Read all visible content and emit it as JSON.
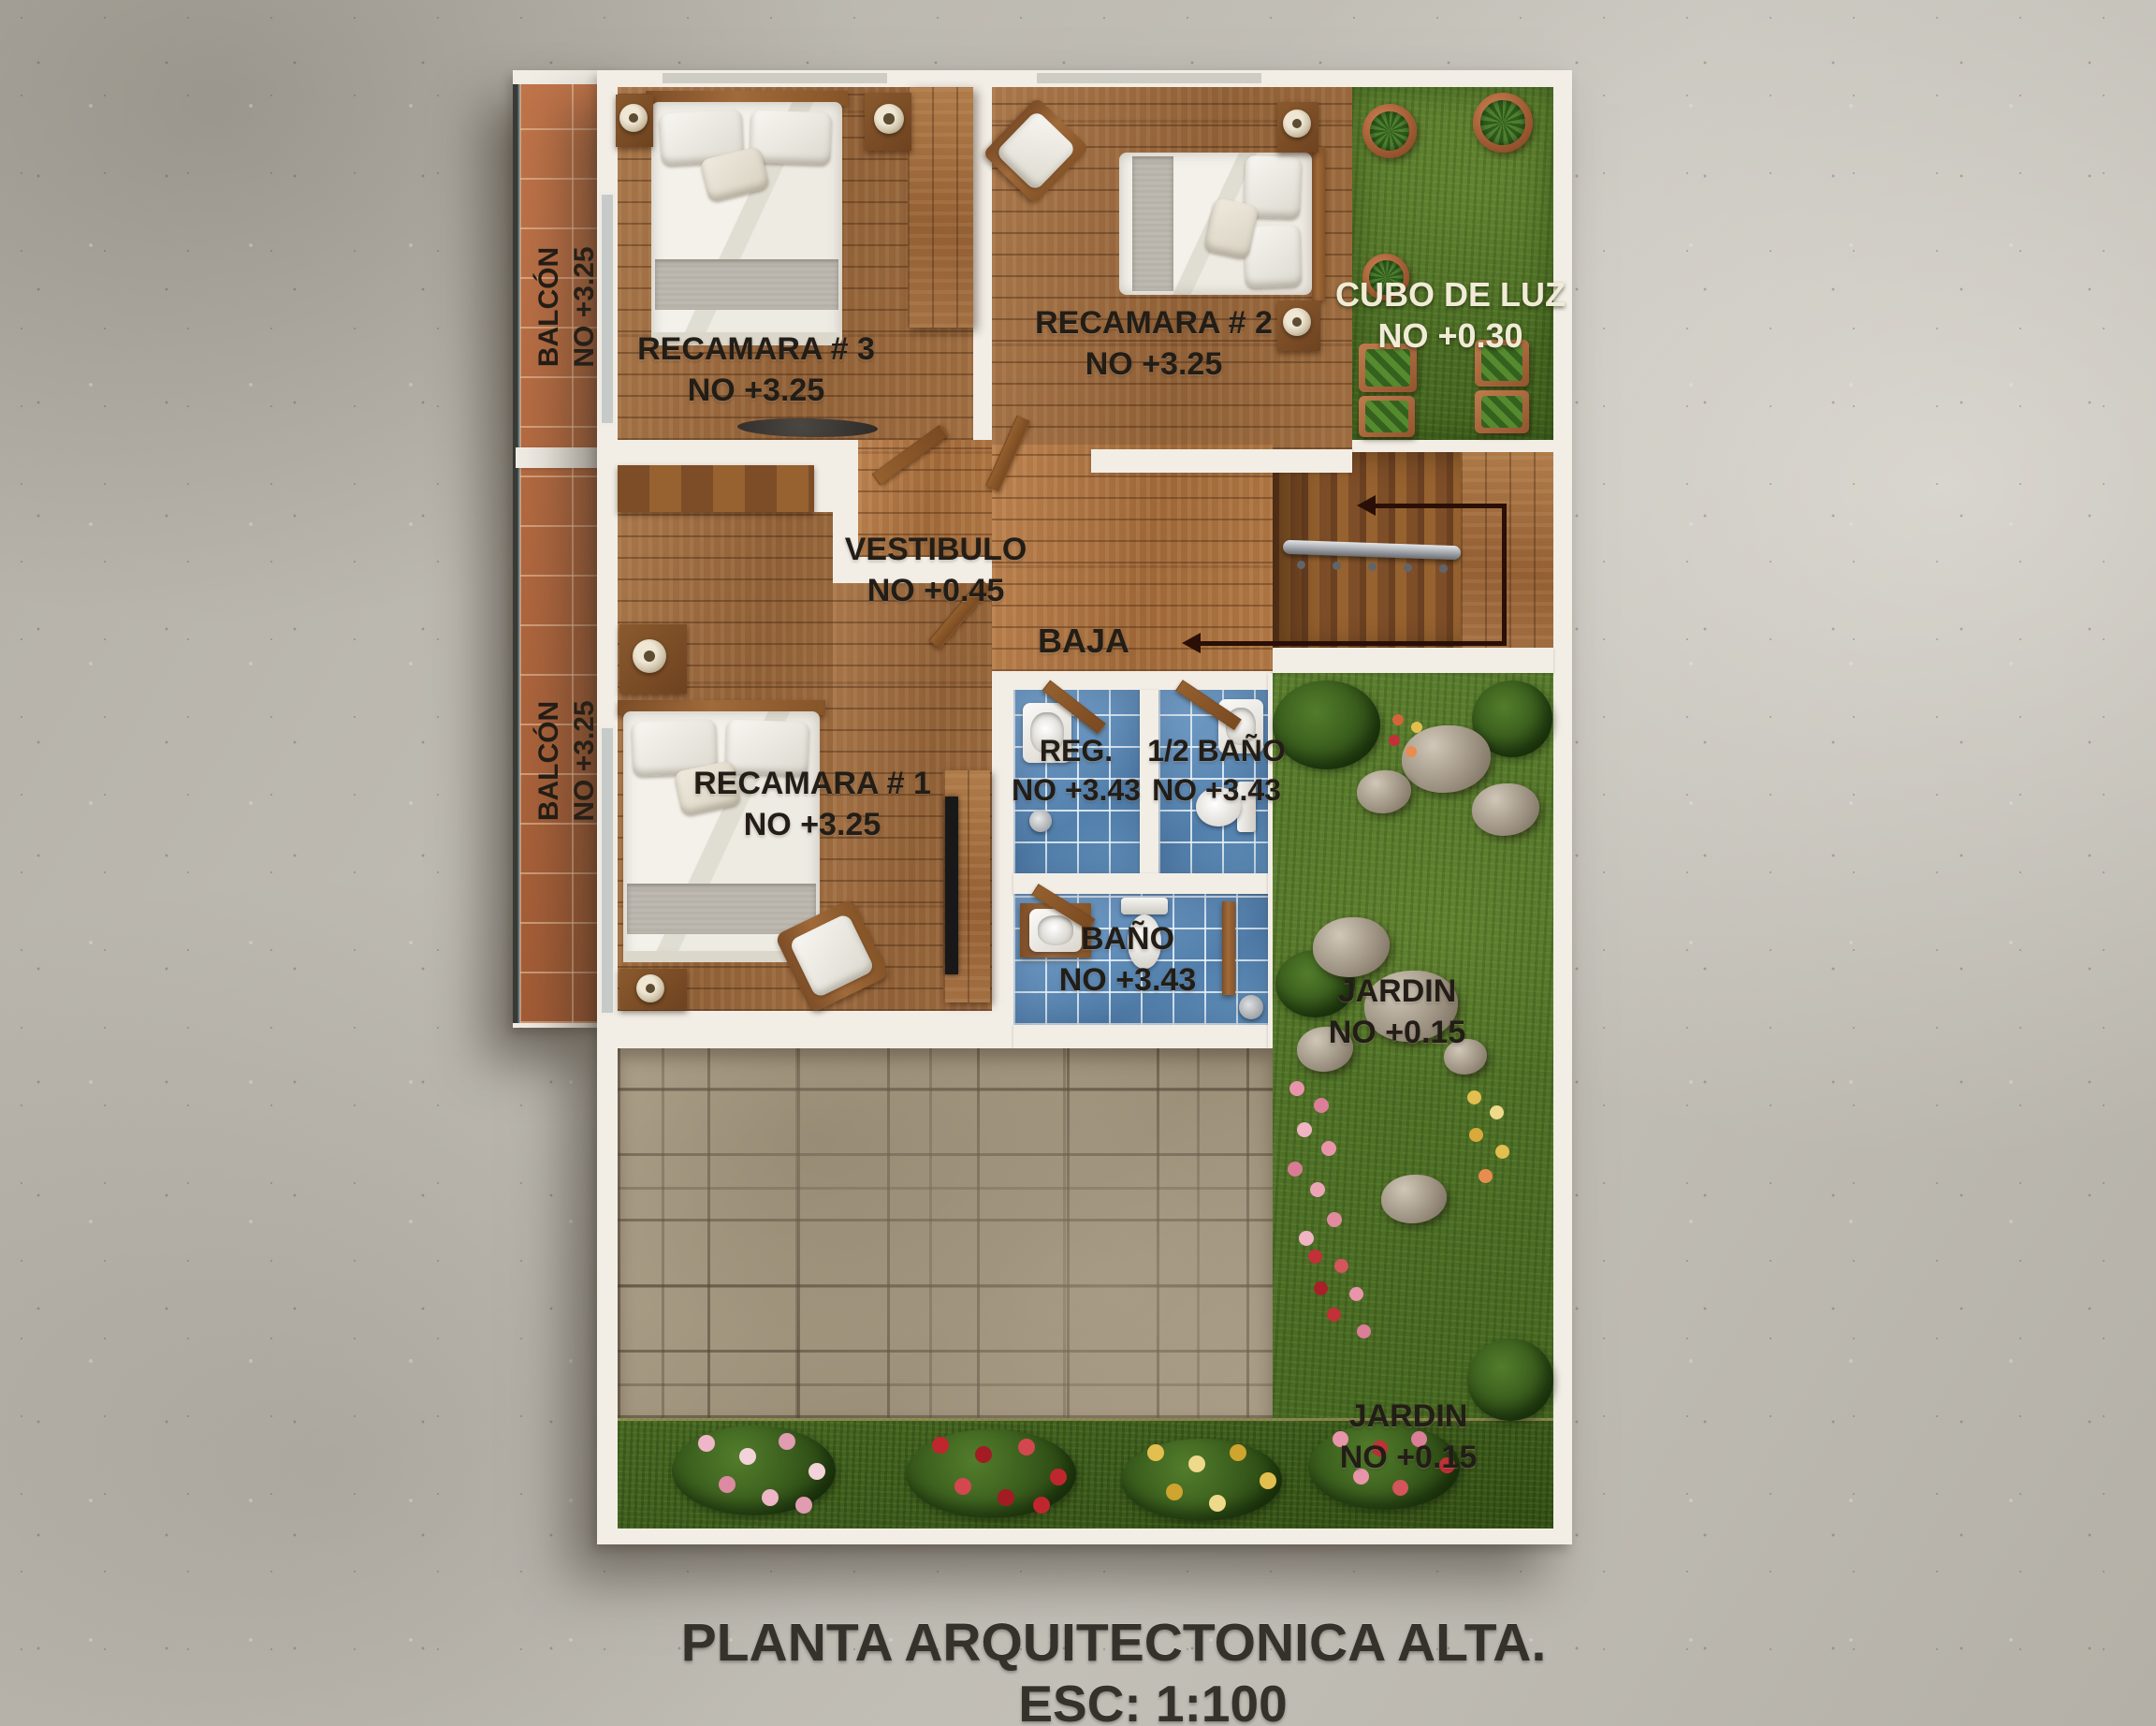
{
  "title": {
    "line1": "PLANTA ARQUITECTONICA ALTA.",
    "line2": "ESC: 1:100"
  },
  "labels": {
    "balcon_top": {
      "name": "BALCÓN",
      "level": "NO +3.25"
    },
    "balcon_bottom": {
      "name": "BALCÓN",
      "level": "NO +3.25"
    },
    "recamara3": {
      "name": "RECAMARA # 3",
      "level": "NO +3.25"
    },
    "recamara2": {
      "name": "RECAMARA # 2",
      "level": "NO +3.25"
    },
    "cubo": {
      "name": "CUBO DE LUZ",
      "level": "NO +0.30"
    },
    "vestibulo": {
      "name": "VESTIBULO",
      "level": "NO +0.45"
    },
    "baja": {
      "text": "BAJA"
    },
    "recamara1": {
      "name": "RECAMARA # 1",
      "level": "NO +3.25"
    },
    "reg": {
      "name": "REG.",
      "level": "NO +3.43"
    },
    "medio_bano": {
      "name": "1/2 BAÑO",
      "level": "NO +3.43"
    },
    "bano": {
      "name": "BAÑO",
      "level": "NO +3.43"
    },
    "jardin_right": {
      "name": "JARDIN",
      "level": "NO +0.15"
    },
    "jardin_bottom": {
      "name": "JARDIN",
      "level": "NO +0.15"
    }
  },
  "colors": {
    "wall": "#f2eee6",
    "wood": "#9a6a3e",
    "terracotta": "#b86c42",
    "tile_blue": "#6495c0",
    "grass": "#527b2c",
    "stone": "#a49880",
    "label_dark": "#221d16",
    "label_light": "#f1ebd6",
    "arrow": "#2a0f06"
  }
}
